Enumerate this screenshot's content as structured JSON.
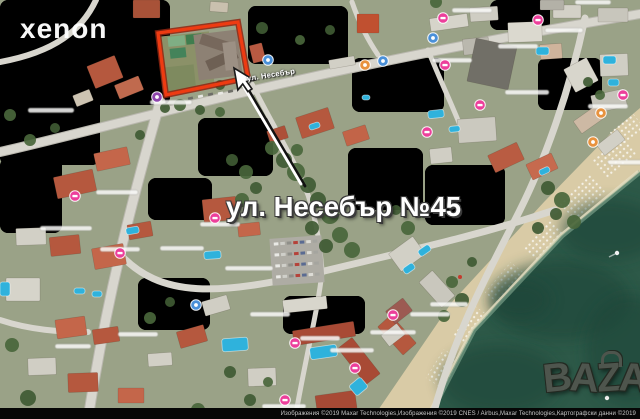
{
  "annotation": {
    "address_label": "ул. Несебър №45"
  },
  "watermarks": {
    "xenon": "xenon",
    "bazar_letters": [
      "B",
      "A",
      "Z",
      "A",
      "R"
    ]
  },
  "map": {
    "road_label": "ул. Несебър",
    "attribution": "Изображения ©2019 Maxar Technologies,Изображения ©2019 CNES / Airbus,Maxar Technologies,Картографски данни ©2019",
    "colors": {
      "base": "#9aa287",
      "road": "#d8d6ce",
      "road_casing": "#b9b7ae",
      "sea": "#2d5948",
      "sea_dark": "#1f4438",
      "beach": "#d9cba6",
      "pool": "#2fb2dc",
      "plot_outline": "#ee3b12",
      "plot_outline_dark": "#8f2410",
      "pin_hotel": "#ec3f9b",
      "pin_info": "#4a90d9",
      "pin_food": "#e8923e",
      "pin_other": "#8e44ad",
      "tree_a": "#3f5a33",
      "tree_b": "#49663b"
    },
    "terrain": [
      [
        0,
        0,
        170,
        105,
        0,
        "#b0a98f",
        1
      ],
      [
        90,
        5,
        70,
        55,
        0,
        "#bab29a",
        0.8
      ],
      [
        0,
        55,
        100,
        110,
        -8,
        "#8d9a75",
        0.9
      ],
      [
        248,
        6,
        100,
        58,
        -7,
        "#97895f",
        0.95
      ],
      [
        198,
        118,
        75,
        58,
        0,
        "#87956e",
        0.9
      ],
      [
        0,
        158,
        62,
        75,
        0,
        "#9aa384",
        0.9
      ],
      [
        348,
        148,
        75,
        62,
        0,
        "#8f9b7d",
        0.9
      ],
      [
        283,
        296,
        82,
        38,
        -6,
        "#7d9160",
        0.9
      ],
      [
        138,
        278,
        72,
        52,
        0,
        "#9ba287",
        0.85
      ],
      [
        538,
        58,
        64,
        52,
        0,
        "#9ca68a",
        0.8
      ],
      [
        352,
        58,
        92,
        54,
        -5,
        "#a89f85",
        0.85
      ],
      [
        148,
        178,
        64,
        42,
        0,
        "#b3ab93",
        0.8
      ],
      [
        425,
        165,
        80,
        60,
        -10,
        "#93a07f",
        0.85
      ],
      [
        490,
        0,
        60,
        30,
        0,
        "#a9a790",
        0.8
      ]
    ],
    "beach_poly": "640,108 640,172 562,236 474,330 428,419 372,419 452,302 544,202 612,132",
    "sea_poly": "640,172 640,419 428,419 474,330 562,236",
    "shore_line": "640,172 562,236 474,330 428,419",
    "sea_blotches": [
      [
        560,
        300,
        70,
        40
      ],
      [
        610,
        230,
        50,
        30
      ],
      [
        500,
        380,
        60,
        35
      ],
      [
        630,
        350,
        45,
        55
      ],
      [
        520,
        300,
        30,
        20
      ]
    ],
    "umbrella_patches": [
      [
        594,
        146,
        40,
        24,
        -40
      ],
      [
        562,
        186,
        42,
        24,
        -44
      ],
      [
        524,
        230,
        42,
        24,
        -47
      ],
      [
        487,
        273,
        40,
        24,
        -50
      ],
      [
        454,
        316,
        38,
        24,
        -54
      ],
      [
        428,
        358,
        34,
        24,
        -58
      ],
      [
        612,
        120,
        30,
        20,
        -38
      ]
    ],
    "red_umbrella": [
      460,
      277
    ],
    "boats": [
      [
        617,
        253
      ],
      [
        607,
        398
      ]
    ],
    "roads": [
      {
        "d": "M0,152 C120,125 300,70 640,14",
        "w": 8,
        "casing": true
      },
      {
        "d": "M160,102 C135,190 108,290 88,419",
        "w": 9,
        "casing": true
      },
      {
        "d": "M118,252 C160,300 220,295 320,272 C420,248 480,235 555,210",
        "w": 7,
        "casing": false
      },
      {
        "d": "M585,18 C570,90 545,160 520,210 C490,270 455,330 432,419",
        "w": 7,
        "casing": false
      },
      {
        "d": "M252,84 C275,130 295,160 308,195 C318,225 320,250 322,270",
        "w": 5,
        "casing": false
      },
      {
        "d": "M96,0 C82,30 55,52 0,62",
        "w": 6,
        "casing": false
      },
      {
        "d": "M352,2 C360,25 368,40 378,55",
        "w": 5,
        "casing": false
      },
      {
        "d": "M0,320 C30,330 60,332 88,332",
        "w": 6,
        "casing": false
      },
      {
        "d": "M322,272 C318,310 305,360 295,419",
        "w": 5,
        "casing": false
      },
      {
        "d": "M428,50 C440,80 450,100 462,130",
        "w": 5,
        "casing": false
      }
    ],
    "parking": {
      "x": 271,
      "y": 237,
      "w": 52,
      "h": 47,
      "rot": -4,
      "fill": "#aeaca4"
    },
    "buildings": [
      [
        133,
        0,
        27,
        18,
        0,
        "#a85238"
      ],
      [
        210,
        2,
        18,
        10,
        4,
        "#c9c0ae"
      ],
      [
        90,
        60,
        30,
        24,
        -22,
        "#b5583e"
      ],
      [
        116,
        80,
        26,
        15,
        -22,
        "#c06a4e"
      ],
      [
        74,
        92,
        18,
        12,
        -22,
        "#cdc4b2"
      ],
      [
        357,
        14,
        22,
        19,
        0,
        "#c05030"
      ],
      [
        251,
        44,
        13,
        18,
        -14,
        "#b85a42"
      ],
      [
        329,
        58,
        26,
        9,
        -10,
        "#d2d0c6"
      ],
      [
        430,
        16,
        38,
        13,
        -8,
        "#d6d4ca"
      ],
      [
        470,
        7,
        28,
        14,
        -4,
        "#cfcdc3"
      ],
      [
        508,
        22,
        34,
        20,
        -2,
        "#dbd9cf"
      ],
      [
        553,
        5,
        28,
        13,
        0,
        "#d3d1c7"
      ],
      [
        598,
        8,
        30,
        14,
        0,
        "#c8c6bc"
      ],
      [
        463,
        38,
        26,
        16,
        -6,
        "#bab8ae"
      ],
      [
        471,
        42,
        42,
        44,
        12,
        "#716f67"
      ],
      [
        540,
        44,
        22,
        15,
        -4,
        "#cfb49c"
      ],
      [
        600,
        54,
        28,
        22,
        -2,
        "#d0cec4"
      ],
      [
        568,
        62,
        26,
        26,
        -28,
        "#d8d6cc"
      ],
      [
        592,
        92,
        34,
        18,
        -12,
        "#c6c4ba"
      ],
      [
        575,
        112,
        28,
        15,
        -35,
        "#cdb9a4"
      ],
      [
        598,
        136,
        26,
        13,
        -38,
        "#d2d0c6"
      ],
      [
        298,
        112,
        34,
        22,
        -18,
        "#b5583e"
      ],
      [
        344,
        128,
        24,
        15,
        -18,
        "#c26448"
      ],
      [
        268,
        128,
        19,
        13,
        -18,
        "#ad5038"
      ],
      [
        458,
        118,
        38,
        24,
        -4,
        "#cbc9bf"
      ],
      [
        490,
        148,
        32,
        19,
        -25,
        "#b95c42"
      ],
      [
        528,
        158,
        28,
        17,
        -25,
        "#c66a4e"
      ],
      [
        430,
        148,
        22,
        15,
        -6,
        "#d0cec4"
      ],
      [
        55,
        173,
        40,
        22,
        -12,
        "#b5583e"
      ],
      [
        95,
        150,
        34,
        18,
        -12,
        "#c4664a"
      ],
      [
        16,
        228,
        30,
        17,
        -2,
        "#d2d0c6"
      ],
      [
        50,
        236,
        30,
        19,
        -6,
        "#b5583e"
      ],
      [
        6,
        278,
        34,
        23,
        0,
        "#d6d4ca"
      ],
      [
        93,
        246,
        32,
        21,
        -10,
        "#c4664a"
      ],
      [
        128,
        223,
        24,
        15,
        -10,
        "#b5583e"
      ],
      [
        203,
        198,
        34,
        23,
        -6,
        "#b5583e"
      ],
      [
        238,
        223,
        22,
        13,
        -6,
        "#c4664a"
      ],
      [
        56,
        318,
        30,
        19,
        -8,
        "#c4664a"
      ],
      [
        93,
        328,
        26,
        15,
        -8,
        "#b5583e"
      ],
      [
        28,
        358,
        28,
        17,
        -2,
        "#d0cec4"
      ],
      [
        68,
        373,
        30,
        19,
        -2,
        "#b5583e"
      ],
      [
        118,
        388,
        26,
        15,
        0,
        "#c4664a"
      ],
      [
        148,
        353,
        24,
        13,
        -4,
        "#d2d0c6"
      ],
      [
        178,
        328,
        28,
        17,
        -16,
        "#b5583e"
      ],
      [
        203,
        298,
        26,
        15,
        -16,
        "#d0cec4"
      ],
      [
        293,
        326,
        62,
        15,
        -9,
        "#a84a35"
      ],
      [
        350,
        338,
        18,
        46,
        -38,
        "#a84a35"
      ],
      [
        388,
        316,
        18,
        38,
        -42,
        "#b5583e"
      ],
      [
        428,
        272,
        18,
        34,
        -42,
        "#c9c7bd"
      ],
      [
        316,
        393,
        40,
        18,
        -8,
        "#a84a35"
      ],
      [
        248,
        368,
        28,
        18,
        -2,
        "#d0cec4"
      ],
      [
        283,
        298,
        44,
        13,
        -6,
        "#d8d6cc"
      ],
      [
        392,
        243,
        30,
        22,
        -36,
        "#d2d0c6"
      ],
      [
        388,
        303,
        22,
        16,
        -38,
        "#9c5a52"
      ],
      [
        383,
        328,
        20,
        14,
        -38,
        "#d0cec4"
      ],
      [
        540,
        0,
        24,
        10,
        0,
        "#b3b1a7"
      ]
    ],
    "plot_interior": [
      [
        160,
        34,
        52,
        56,
        -6,
        "#8b9168"
      ],
      [
        163,
        66,
        32,
        26,
        -6,
        "#7e8a5f"
      ],
      [
        168,
        36,
        17,
        10,
        -6,
        "#7fae84"
      ],
      [
        186,
        34,
        16,
        10,
        -6,
        "#3f7d4e"
      ],
      [
        170,
        48,
        16,
        10,
        -6,
        "#44835a"
      ],
      [
        196,
        32,
        44,
        46,
        -7,
        "#8d8174"
      ],
      [
        200,
        38,
        32,
        11,
        18,
        "#77685c"
      ],
      [
        206,
        54,
        32,
        11,
        -24,
        "#6e6054"
      ],
      [
        224,
        42,
        13,
        28,
        -7,
        "#9c9084"
      ]
    ],
    "plot_outline_points": "158,33 238,22 248,78 166,95",
    "pointer_line": {
      "x1": 241,
      "y1": 82,
      "x2": 301,
      "y2": 184,
      "x1b": 245,
      "y1b": 84,
      "x2b": 305,
      "y2b": 186
    },
    "cursor": {
      "x": 234,
      "y": 68,
      "rot": -10,
      "scale": 1.35
    },
    "pools": [
      [
        418,
        247,
        13,
        7,
        -35
      ],
      [
        403,
        265,
        12,
        7,
        -35
      ],
      [
        222,
        338,
        26,
        13,
        -4
      ],
      [
        310,
        346,
        27,
        12,
        -8
      ],
      [
        351,
        380,
        15,
        13,
        -40
      ],
      [
        204,
        251,
        17,
        8,
        -4
      ],
      [
        126,
        227,
        13,
        7,
        -10
      ],
      [
        74,
        288,
        11,
        6,
        0
      ],
      [
        0,
        282,
        10,
        14,
        0
      ],
      [
        536,
        47,
        13,
        8,
        0
      ],
      [
        428,
        110,
        16,
        8,
        -6
      ],
      [
        449,
        126,
        11,
        6,
        -6
      ],
      [
        603,
        56,
        13,
        8,
        0
      ],
      [
        608,
        79,
        11,
        7,
        0
      ],
      [
        309,
        123,
        11,
        6,
        -18
      ],
      [
        539,
        168,
        11,
        6,
        -25
      ],
      [
        362,
        95,
        8,
        5,
        0
      ],
      [
        92,
        291,
        10,
        6,
        0
      ]
    ],
    "trees": [
      [
        272,
        148,
        7
      ],
      [
        284,
        160,
        8
      ],
      [
        296,
        172,
        9
      ],
      [
        308,
        185,
        8
      ],
      [
        297,
        150,
        6
      ],
      [
        318,
        200,
        8
      ],
      [
        330,
        215,
        9
      ],
      [
        312,
        228,
        7
      ],
      [
        340,
        235,
        8
      ],
      [
        326,
        246,
        7
      ],
      [
        352,
        250,
        8
      ],
      [
        232,
        160,
        6
      ],
      [
        246,
        172,
        7
      ],
      [
        256,
        188,
        6
      ],
      [
        242,
        200,
        7
      ],
      [
        262,
        28,
        6
      ],
      [
        300,
        40,
        5
      ],
      [
        330,
        30,
        5
      ],
      [
        180,
        105,
        6
      ],
      [
        200,
        110,
        5
      ],
      [
        220,
        112,
        5
      ],
      [
        548,
        188,
        7
      ],
      [
        562,
        200,
        8
      ],
      [
        556,
        214,
        6
      ],
      [
        574,
        222,
        7
      ],
      [
        538,
        228,
        6
      ],
      [
        452,
        282,
        6
      ],
      [
        462,
        300,
        7
      ],
      [
        444,
        316,
        6
      ],
      [
        472,
        262,
        5
      ],
      [
        12,
        345,
        7
      ],
      [
        28,
        398,
        8
      ],
      [
        150,
        318,
        6
      ],
      [
        170,
        302,
        5
      ],
      [
        198,
        410,
        7
      ],
      [
        250,
        400,
        6
      ],
      [
        268,
        382,
        5
      ],
      [
        230,
        372,
        6
      ],
      [
        600,
        95,
        5
      ],
      [
        588,
        82,
        5
      ],
      [
        30,
        140,
        6
      ],
      [
        55,
        128,
        5
      ],
      [
        10,
        115,
        6
      ],
      [
        140,
        135,
        5
      ],
      [
        436,
        2,
        6
      ],
      [
        420,
        212,
        6
      ],
      [
        408,
        228,
        7
      ],
      [
        396,
        210,
        5
      ],
      [
        205,
        82,
        6
      ],
      [
        220,
        85,
        5
      ],
      [
        190,
        86,
        5
      ],
      [
        165,
        108,
        5
      ]
    ],
    "pins": [
      {
        "x": 75,
        "y": 196,
        "t": "hotel"
      },
      {
        "x": 120,
        "y": 253,
        "t": "hotel"
      },
      {
        "x": 215,
        "y": 218,
        "t": "hotel"
      },
      {
        "x": 295,
        "y": 343,
        "t": "hotel"
      },
      {
        "x": 393,
        "y": 315,
        "t": "hotel"
      },
      {
        "x": 355,
        "y": 368,
        "t": "hotel"
      },
      {
        "x": 285,
        "y": 400,
        "t": "hotel"
      },
      {
        "x": 443,
        "y": 18,
        "t": "hotel"
      },
      {
        "x": 538,
        "y": 20,
        "t": "hotel"
      },
      {
        "x": 445,
        "y": 65,
        "t": "hotel"
      },
      {
        "x": 427,
        "y": 132,
        "t": "hotel"
      },
      {
        "x": 480,
        "y": 105,
        "t": "hotel"
      },
      {
        "x": 623,
        "y": 95,
        "t": "hotel"
      },
      {
        "x": 268,
        "y": 60,
        "t": "info"
      },
      {
        "x": 383,
        "y": 61,
        "t": "info"
      },
      {
        "x": 433,
        "y": 38,
        "t": "info"
      },
      {
        "x": 196,
        "y": 305,
        "t": "info"
      },
      {
        "x": 365,
        "y": 65,
        "t": "food"
      },
      {
        "x": 601,
        "y": 113,
        "t": "food"
      },
      {
        "x": 593,
        "y": 142,
        "t": "food"
      },
      {
        "x": 157,
        "y": 97,
        "t": "other"
      }
    ],
    "label_smudges": [
      [
        28,
        108,
        46
      ],
      [
        96,
        190,
        42
      ],
      [
        40,
        226,
        52
      ],
      [
        100,
        247,
        40
      ],
      [
        160,
        246,
        44
      ],
      [
        225,
        266,
        48
      ],
      [
        118,
        332,
        40
      ],
      [
        55,
        344,
        36
      ],
      [
        452,
        8,
        40
      ],
      [
        545,
        28,
        38
      ],
      [
        505,
        90,
        44
      ],
      [
        588,
        104,
        40
      ],
      [
        370,
        330,
        46
      ],
      [
        300,
        336,
        40
      ],
      [
        430,
        302,
        38
      ],
      [
        150,
        100,
        42
      ],
      [
        250,
        312,
        40
      ],
      [
        200,
        222,
        40
      ],
      [
        330,
        348,
        44
      ],
      [
        262,
        404,
        44
      ],
      [
        410,
        312,
        40
      ],
      [
        575,
        0,
        36
      ],
      [
        608,
        160,
        36
      ],
      [
        432,
        58,
        40
      ],
      [
        498,
        44,
        40
      ]
    ],
    "road_cars": [
      [
        188,
        97
      ],
      [
        198,
        95
      ],
      [
        208,
        93
      ],
      [
        218,
        92
      ],
      [
        228,
        90
      ]
    ]
  }
}
